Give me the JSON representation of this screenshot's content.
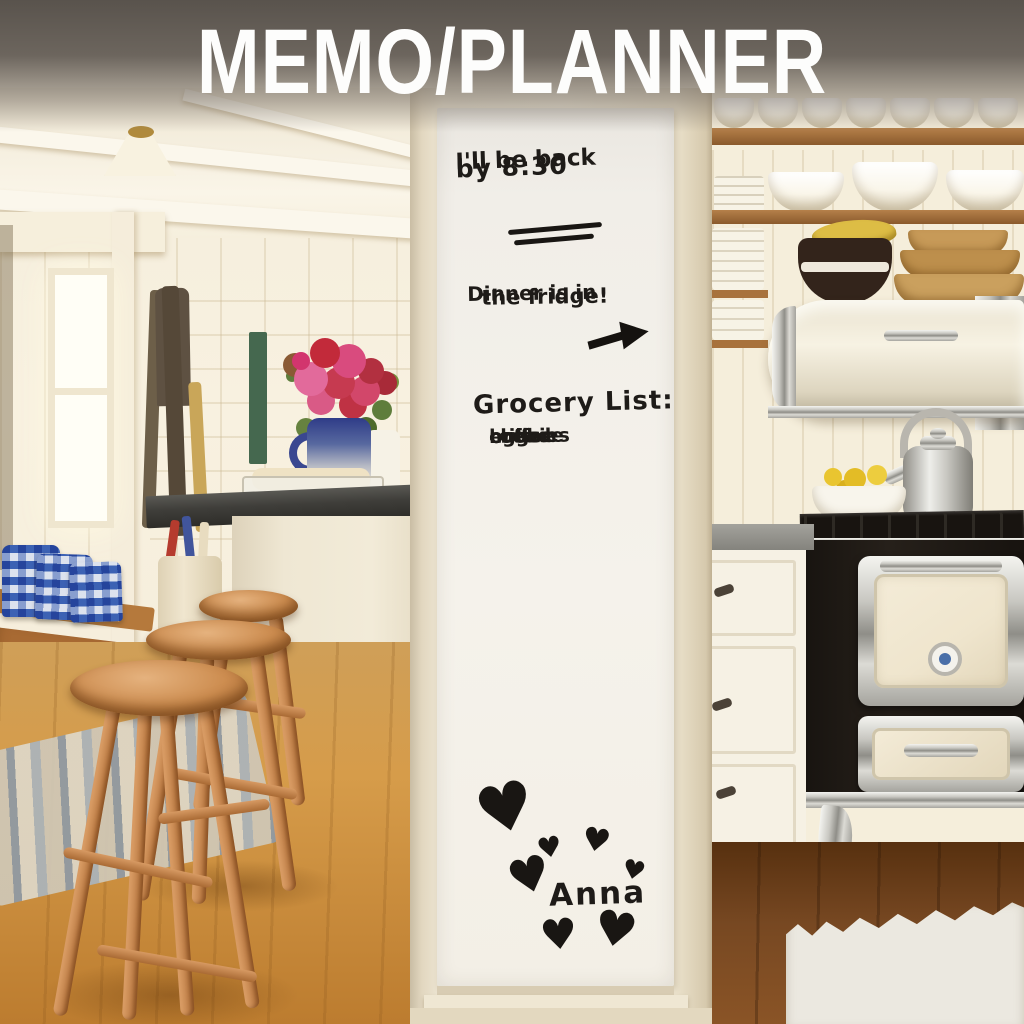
{
  "banner": {
    "title": "MEMO/PLANNER",
    "bg_color": "#5f5952",
    "text_color": "#ffffff"
  },
  "whiteboard": {
    "ink_color": "#1e1b18",
    "note_back": {
      "line1": "I'll be back",
      "line2": "by 8:30"
    },
    "note_dinner": {
      "line1": "Dinner is in",
      "line2": "the fridge!"
    },
    "grocery": {
      "title": "Grocery List:",
      "items": [
        "bread",
        "eggs",
        "coffee",
        "cheese",
        "milk",
        "cookies"
      ]
    },
    "signature": "Anna",
    "heart_glyph": "♥"
  },
  "scene_colors": {
    "wall_cream": "#f5eedb",
    "wood_stool": "#c98a4f",
    "floor_honey": "#cf9850",
    "floor_dark": "#6b4226",
    "counter_dark": "#3f3e3a",
    "stove_black": "#1c1714",
    "stove_cream_panel": "#efe5cd",
    "gingham_blue": "#3f66b8",
    "flower_pink": "#d2356e",
    "lemon_yellow": "#e9c530"
  }
}
